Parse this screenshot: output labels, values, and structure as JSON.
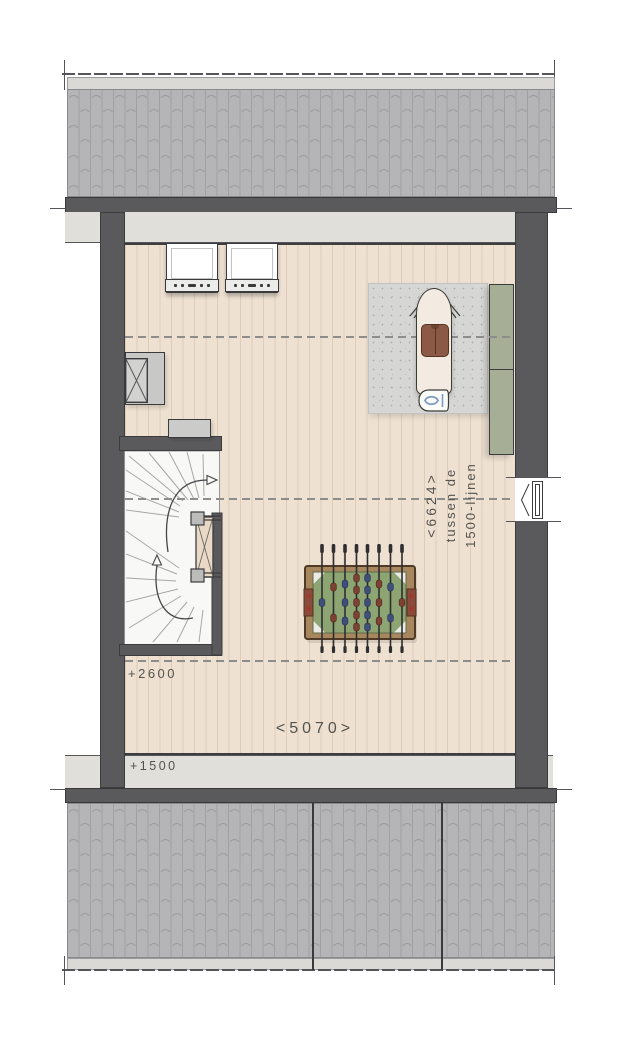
{
  "drawing": {
    "annotations": {
      "width_dimension": "<5070>",
      "height_dimension": "<6624>",
      "height_dimension_note_line1": "tussen de",
      "height_dimension_note_line2": "1500-lijnen",
      "level_upper": "+2600",
      "level_lower": "+1500"
    },
    "colors": {
      "wall_dark": "#5a5a5c",
      "roof_tile_gray": "#b5b5b7",
      "eaves_strip": "#e1dfda",
      "wood_floor": "#eee1d2",
      "stair_white": "#f8f8f7",
      "stair_void_beige": "#ead9c6",
      "rug_gray": "#d6d6d4",
      "cabinet_green": "#a6ae95",
      "foosball_frame_brown": "#a8875f",
      "foosball_field_green": "#8da572",
      "player_blue": "#3f4e7a",
      "player_red": "#7c4234",
      "garment_brown": "#8b5946",
      "annotation_text": "#53534e",
      "dashed_line_gray": "#8d8d8b"
    }
  }
}
